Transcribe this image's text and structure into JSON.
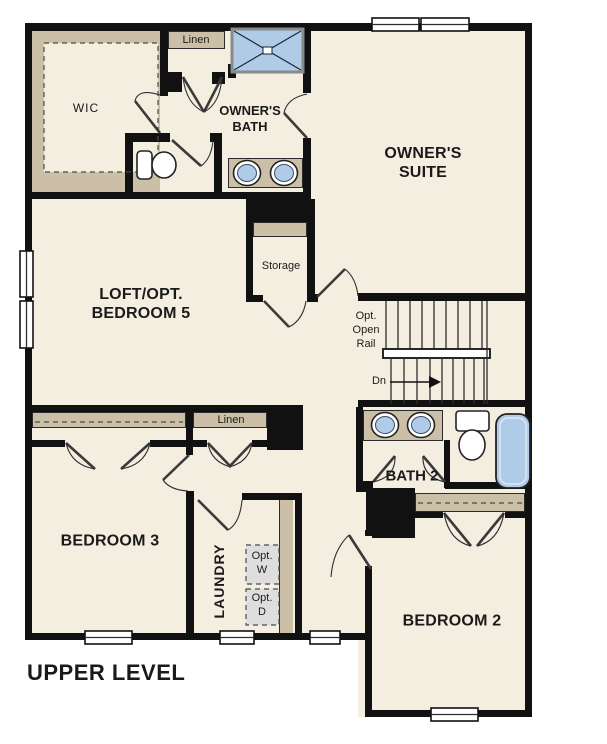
{
  "title": "UPPER LEVEL",
  "rooms": {
    "wic": "WIC",
    "linen_upper": "Linen",
    "owners_bath_1": "OWNER'S",
    "owners_bath_2": "BATH",
    "owners_suite_1": "OWNER'S",
    "owners_suite_2": "SUITE",
    "loft_1": "LOFT/OPT.",
    "loft_2": "BEDROOM 5",
    "storage": "Storage",
    "linen_hall": "Linen",
    "bedroom3": "BEDROOM 3",
    "laundry": "LAUNDRY",
    "bath2": "BATH 2",
    "bedroom2": "BEDROOM 2"
  },
  "annotations": {
    "opt_open_rail_1": "Opt.",
    "opt_open_rail_2": "Open",
    "opt_open_rail_3": "Rail",
    "down": "Dn",
    "opt_w_1": "Opt.",
    "opt_w_2": "W",
    "opt_d_1": "Opt.",
    "opt_d_2": "D"
  },
  "colors": {
    "floor": "#F4EEE1",
    "wall": "#111111",
    "tan": "#CBC0A7",
    "blue": "#AFCBE7",
    "gray": "#DEDEDE",
    "ink": "#1A1A1A"
  }
}
